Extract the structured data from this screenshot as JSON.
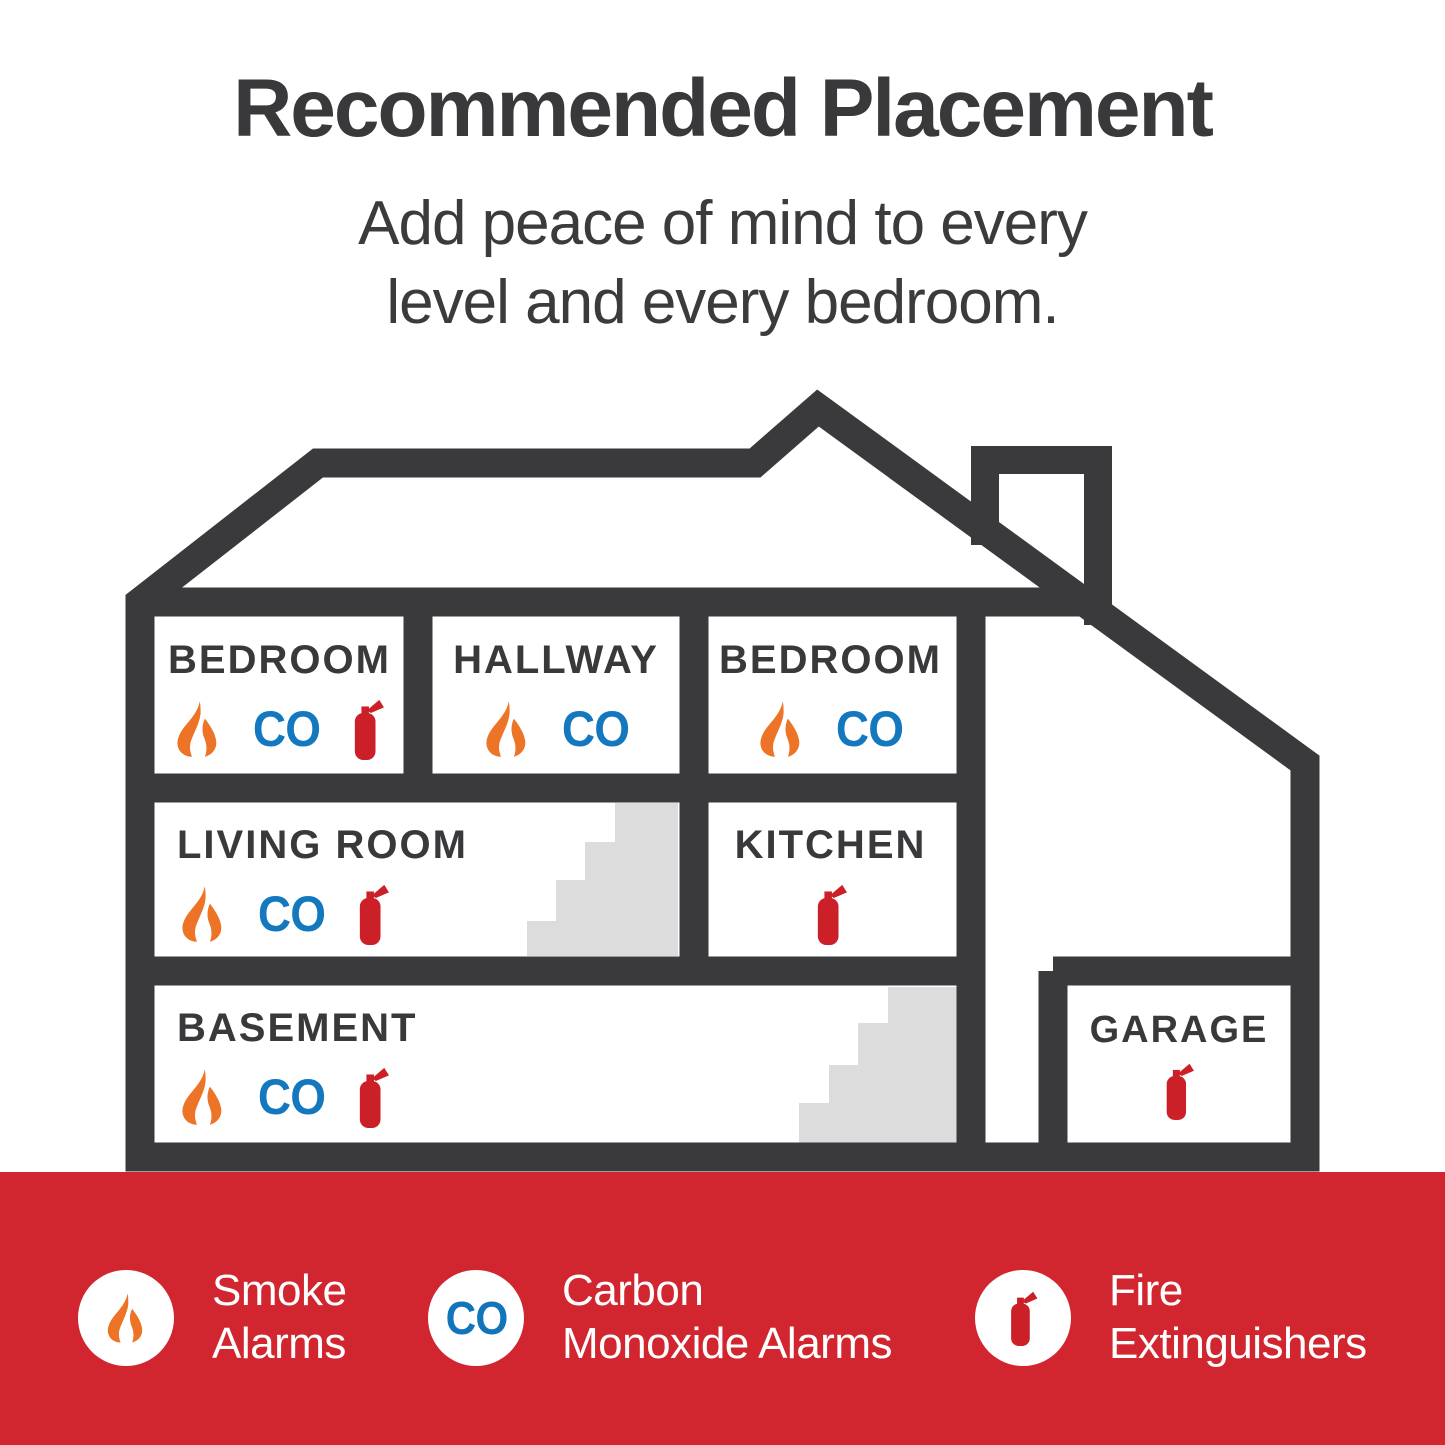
{
  "header": {
    "title": "Recommended Placement",
    "subtitle_line1": "Add peace of mind to every",
    "subtitle_line2": "level and every bedroom."
  },
  "labels": {
    "co": "CO"
  },
  "rooms": {
    "bedroom1": {
      "label": "BEDROOM",
      "devices": [
        "smoke-alarm",
        "co-alarm",
        "fire-extinguisher"
      ]
    },
    "hallway": {
      "label": "HALLWAY",
      "devices": [
        "smoke-alarm",
        "co-alarm"
      ]
    },
    "bedroom2": {
      "label": "BEDROOM",
      "devices": [
        "smoke-alarm",
        "co-alarm"
      ]
    },
    "living_room": {
      "label": "LIVING ROOM",
      "devices": [
        "smoke-alarm",
        "co-alarm",
        "fire-extinguisher"
      ]
    },
    "kitchen": {
      "label": "KITCHEN",
      "devices": [
        "fire-extinguisher"
      ]
    },
    "basement": {
      "label": "BASEMENT",
      "devices": [
        "smoke-alarm",
        "co-alarm",
        "fire-extinguisher"
      ]
    },
    "garage": {
      "label": "GARAGE",
      "devices": [
        "fire-extinguisher"
      ]
    }
  },
  "legend": {
    "smoke": {
      "line1": "Smoke",
      "line2": "Alarms"
    },
    "co": {
      "badge": "CO",
      "line1": "Carbon",
      "line2": "Monoxide Alarms"
    },
    "fire": {
      "line1": "Fire",
      "line2": "Extinguishers"
    }
  },
  "colors": {
    "structure_dark": "#3a393c",
    "text_dark": "#39383b",
    "flame_orange": "#ed7326",
    "co_blue": "#1478bf",
    "extinguisher_red": "#cc2028",
    "footer_red": "#d1252f",
    "stairs_gray": "#dcdcdc",
    "background": "#ffffff"
  }
}
